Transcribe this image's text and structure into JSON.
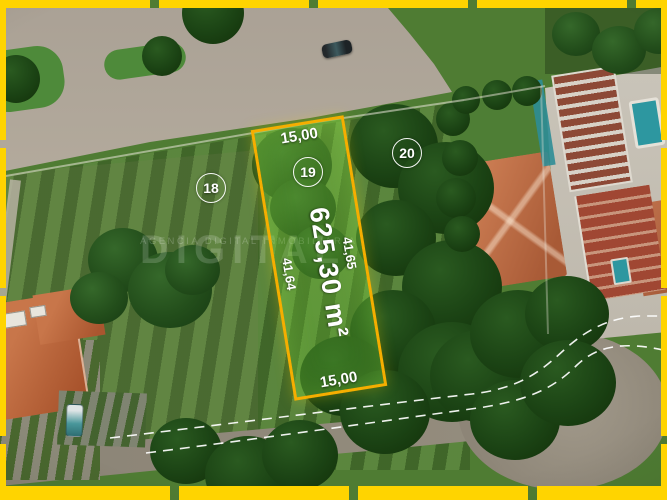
{
  "annotations": {
    "lots": [
      {
        "number": "18"
      },
      {
        "number": "19"
      },
      {
        "number": "20"
      }
    ],
    "measurements": {
      "front": "15,00",
      "back": "15,00",
      "side_left": "41,64",
      "side_right": "41,65"
    },
    "area": "625,30 m²"
  },
  "watermark": {
    "title": "DIGITAL",
    "subtitle": "AGENCIA DIGITAL INMOBILIARIA"
  },
  "colors": {
    "frame_yellow": "#ffd400",
    "lot_border": "#f5ae00",
    "annotation_text": "#ffffff"
  }
}
